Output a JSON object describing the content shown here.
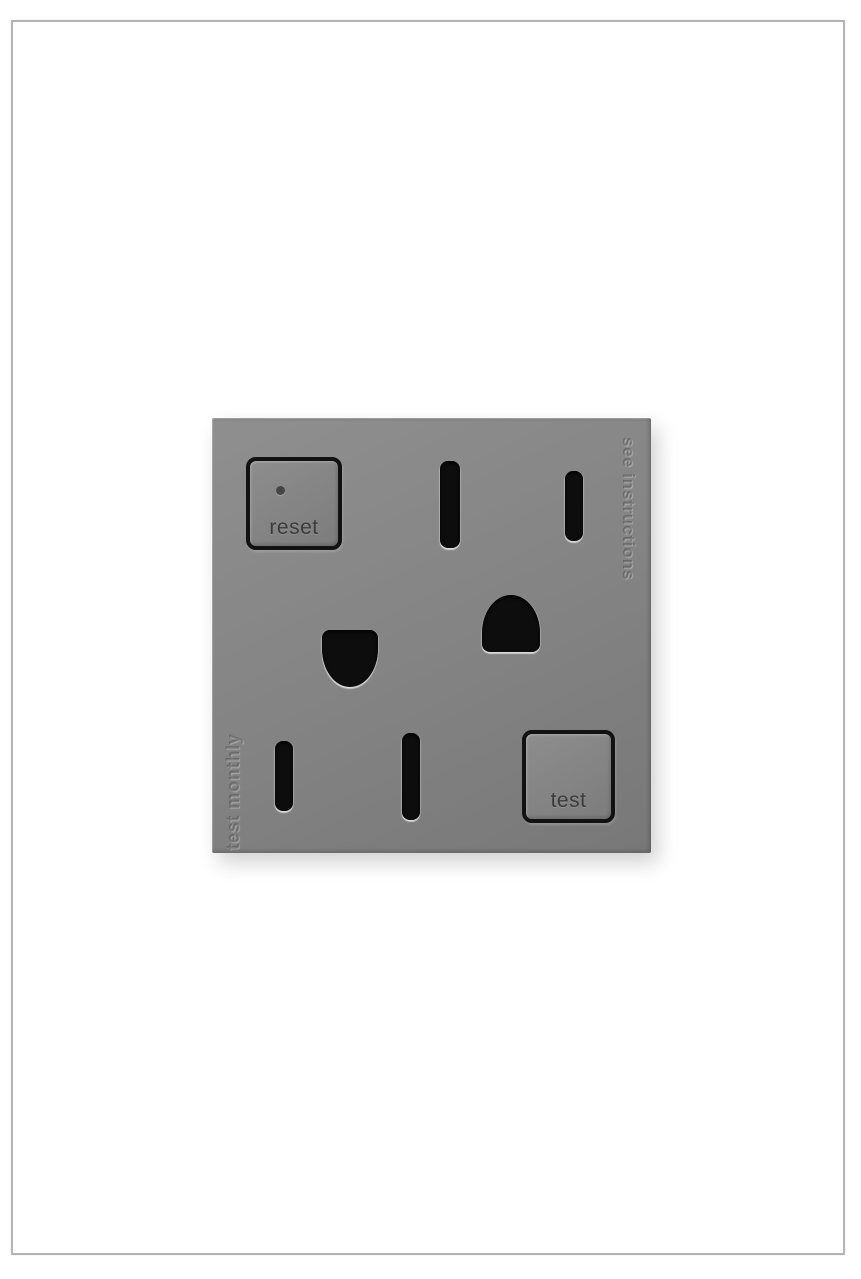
{
  "image": {
    "description": "Product photo of a gray tamper-resistant GFCI duplex outlet",
    "background_color": "#ffffff",
    "frame_border_color": "#b4b4b4"
  },
  "outlet": {
    "plate_color": "#848484",
    "hole_color": "#0d0d0d",
    "button_outline_color": "#121212",
    "label_text_color": "#3b3b3b",
    "reset_button": {
      "label": "reset"
    },
    "test_button": {
      "label": "test"
    },
    "engravings": {
      "see_instructions": "see instructions",
      "test_monthly": "test monthly"
    }
  }
}
